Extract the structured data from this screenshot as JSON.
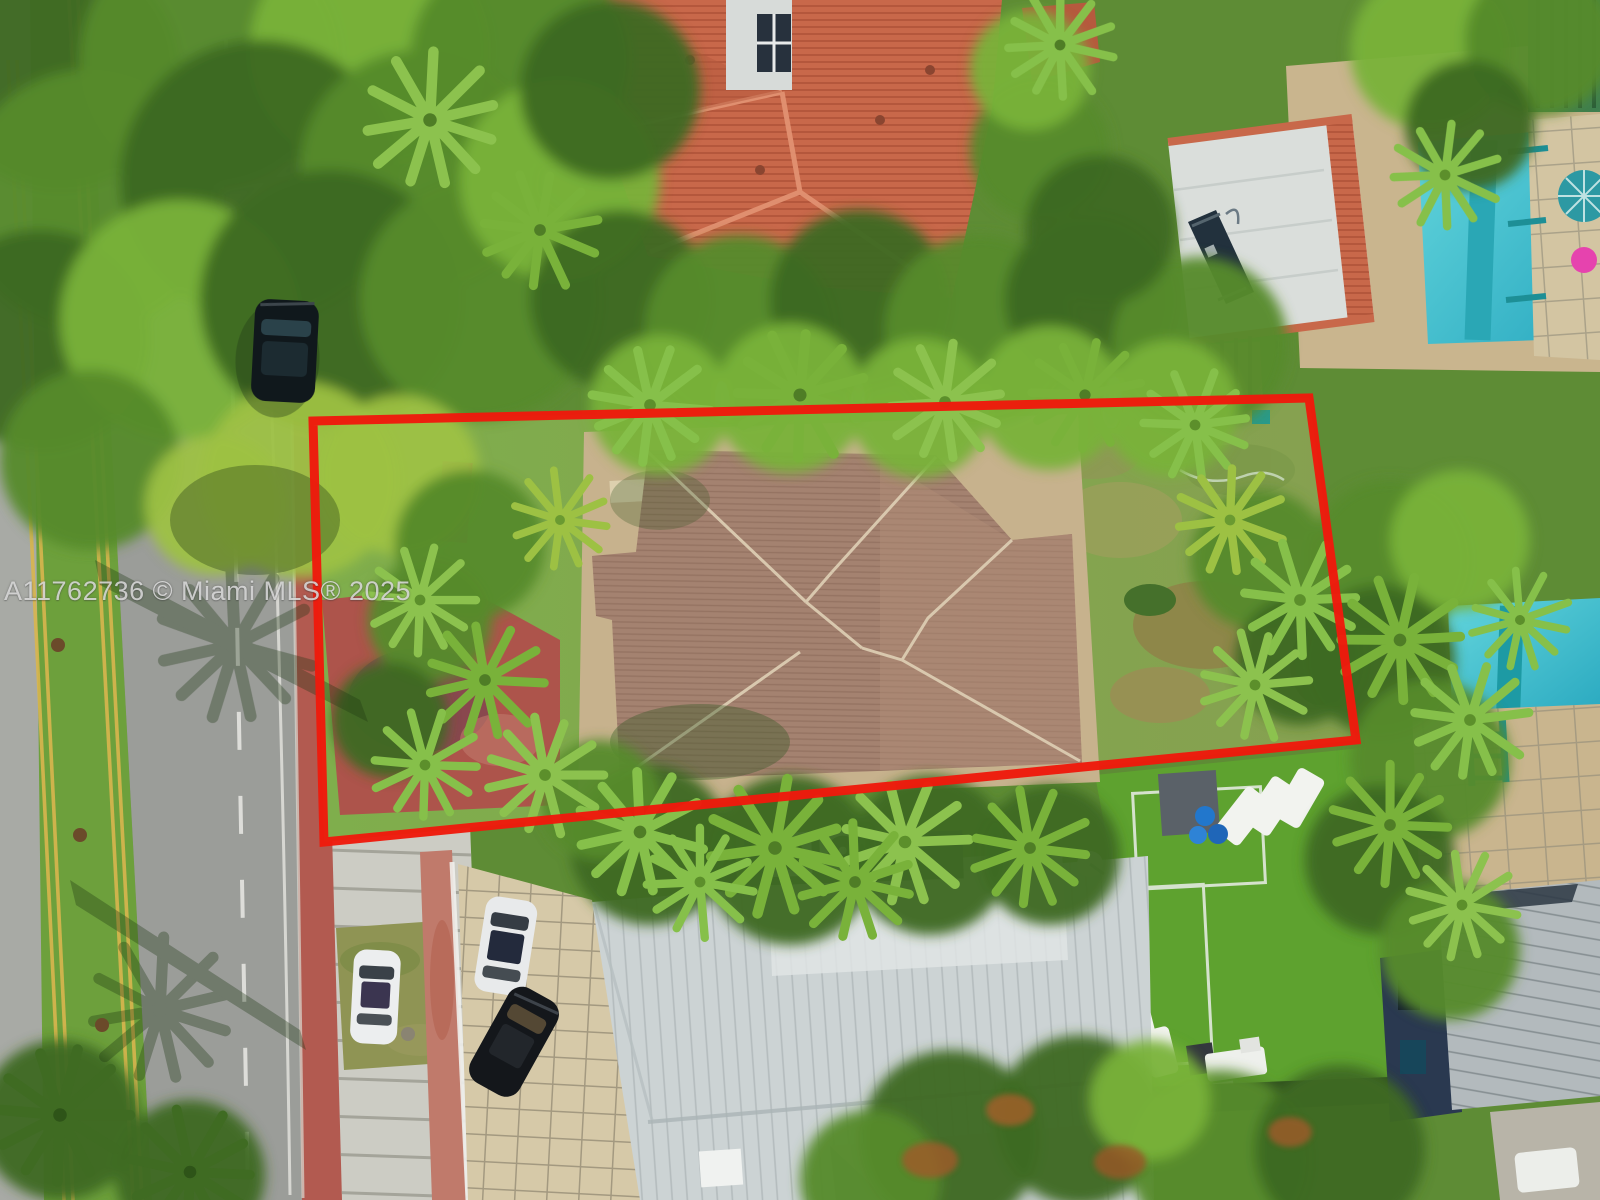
{
  "image": {
    "type": "aerial-drone-real-estate-photo",
    "watermark": "A11762736 © Miami MLS® 2025",
    "subject": "single-family lot outlined in red with tan hip-roof house, street on left, neighboring homes and pools"
  },
  "colors": {
    "canopyDark": "#3d6a23",
    "canopyMid": "#568a2c",
    "canopyBright": "#79b23a",
    "canopyLime": "#9dc143",
    "median": "#6da03c",
    "road": "#9b9d99",
    "yellowLine": "#d9b64e",
    "whiteMarking": "#e9e9e4",
    "brickSidewalk": "#b25a50",
    "redPatio": "#ad544b",
    "concrete": "#ccccc4",
    "driveway": "#d6c9a8",
    "lotLawn": "#7ba348",
    "stoneApron": "#c7b28d",
    "subjectRoof": "#a48270",
    "subjectRidge": "#dcccb2",
    "orangeRoof": "#c8684a",
    "neRoofWhite": "#dadedb",
    "solarPanel": "#22313d",
    "pool": "#3fc1cf",
    "poolLane": "#1d9aa4",
    "tealEdge": "#17858d",
    "sand": "#c9b58e",
    "turf": "#5ea22f",
    "southRoof": "#ccd3d4",
    "metalRoof": "#b3babd",
    "navyWall": "#2a3950",
    "carWhite": "#eceeef",
    "carBlack": "#14171b",
    "boundary": "#ee1a0c"
  },
  "scene": {
    "regions": [
      "tree-canopy",
      "median-strip-with-palms",
      "two-lane-road",
      "red-brick-sidewalk",
      "red-property-boundary",
      "subject-lot-lawn",
      "subject-house-tan-hip-roof",
      "red-stamped-patio",
      "orange-tile-roof-house-north",
      "flat-roof-house-with-solar-panel",
      "pool-northeast",
      "satellite-dish-building-east",
      "pool-east",
      "paver-deck-with-teal-ladder",
      "navy-house-metal-roof",
      "white-metal-roof-house-south",
      "driveway-pavers",
      "artificial-turf-yard-with-loungers",
      "parked-cars"
    ]
  }
}
